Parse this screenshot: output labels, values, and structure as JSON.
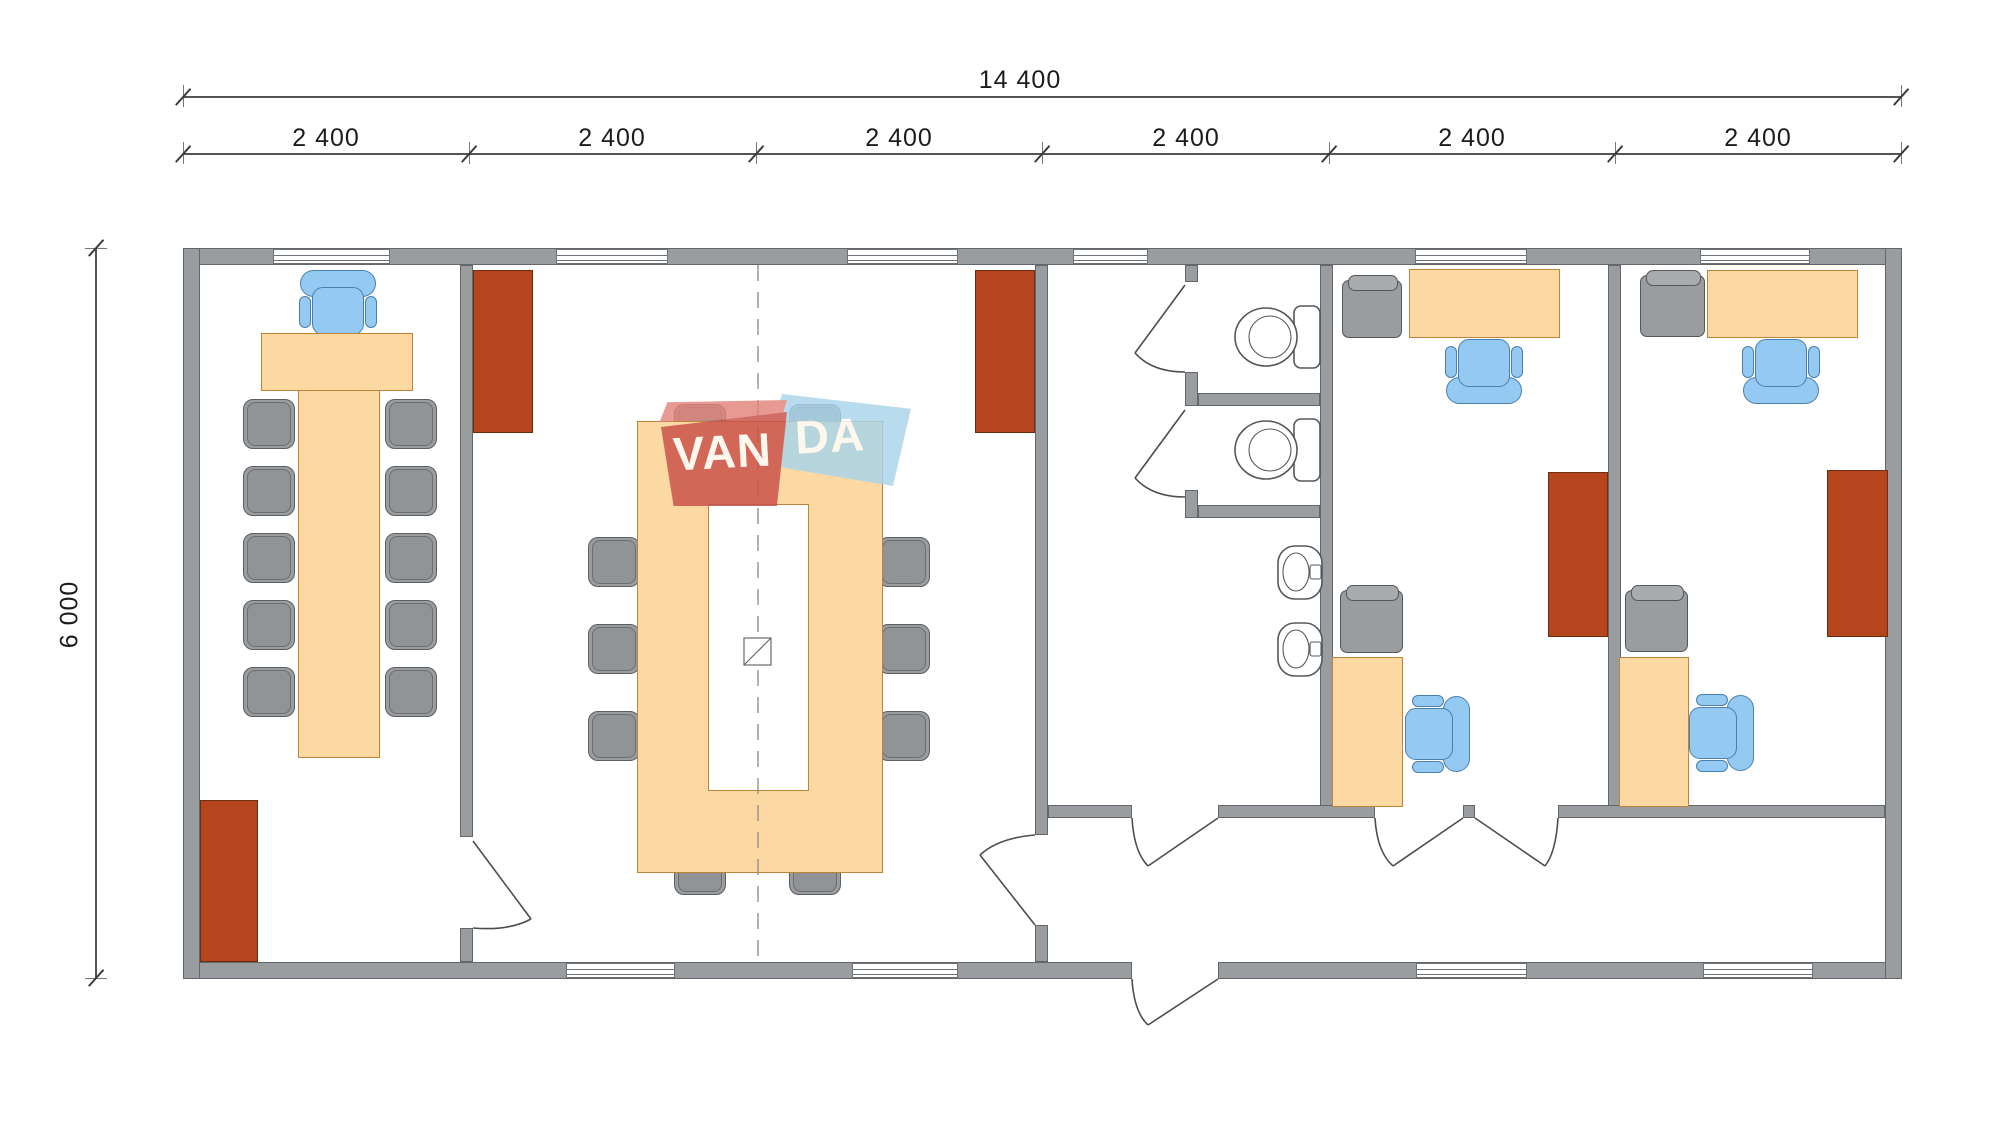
{
  "drawing": {
    "type": "modular-building-floor-plan",
    "dimensions": {
      "total_width_label": "14 400",
      "module_labels": [
        "2 400",
        "2 400",
        "2 400",
        "2 400",
        "2 400",
        "2 400"
      ],
      "height_label": "6 000"
    },
    "watermark": {
      "text_left": "VAN",
      "text_right": "DA"
    },
    "colors": {
      "wall_gray": "#9a9da0",
      "furniture_orange": "#fcd8a2",
      "cabinet_brown": "#b5451d",
      "chair_blue": "#94c9f1",
      "chair_gray": "#9a9da0",
      "dimension_line": "#555555",
      "background": "#ffffff"
    }
  }
}
